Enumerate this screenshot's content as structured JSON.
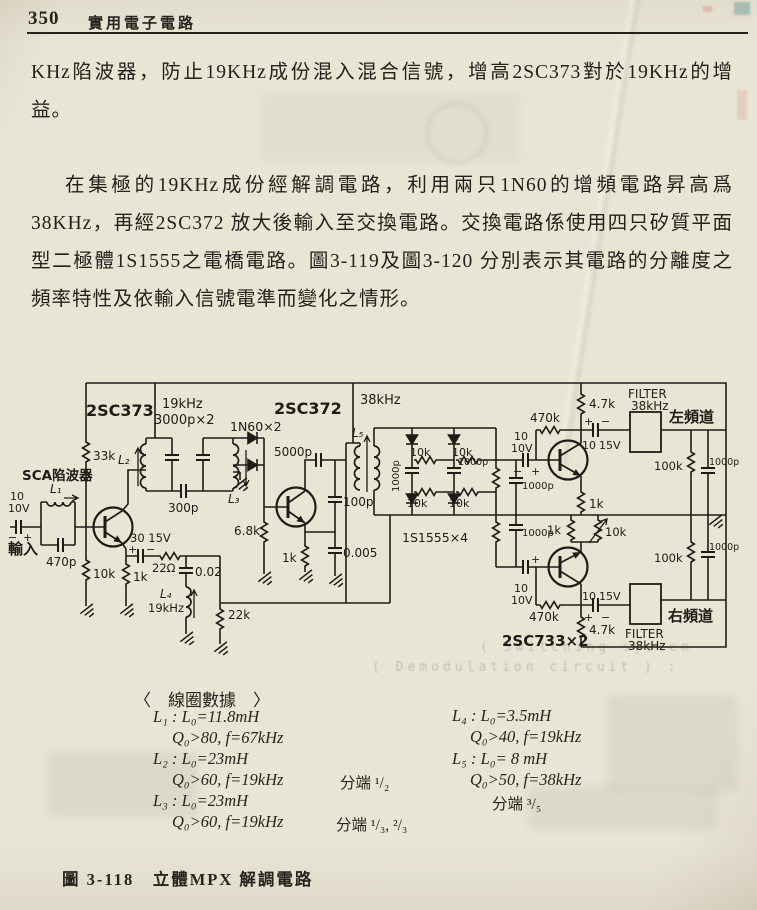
{
  "header": {
    "page_number": "350",
    "book_title": "實用電子電路"
  },
  "paragraphs": {
    "p1": "KHz陷波器，防止19KHz成份混入混合信號，增高2SC373對於19KHz的增益。",
    "p2": "在集極的19KHz成份經解調電路，利用兩只1N60的增頻電路昇高爲38KHz，再經2SC372 放大後輸入至交換電路。交換電路係使用四只矽質平面型二極體1S1555之電橋電路。圖3-119及圖3-120 分別表示其電路的分離度之頻率特性及依輸入信號電準而變化之情形。"
  },
  "circuit": {
    "labels": {
      "t1": "2SC373",
      "t2": "2SC372",
      "t3": "2SC733×2",
      "f19": "19kHz",
      "f38": "38kHz",
      "c3000": "3000p×2",
      "d160": "1N60×2",
      "dbr": "1S1555×4",
      "L1": "L₁",
      "L2": "L₂",
      "L3": "L₃",
      "L4": "L₄",
      "L5": "L₅",
      "sca": "SCA陷波器",
      "input": "輸入",
      "chL": "左頻道",
      "chR": "右頻道",
      "r33k": "33k",
      "r10k": "10k",
      "r1k": "1k",
      "r22o": "22Ω",
      "r22k": "22k",
      "r68k": "6.8k",
      "r47k": "4.7k",
      "r470k": "470k",
      "r100k": "100k",
      "c470p": "470p",
      "c300p": "300p",
      "c5000p": "5000p",
      "c100p": "100p",
      "c1000p": "1000p",
      "c0005": "0.005",
      "c002": "0.02",
      "v10": "10",
      "v10v": "10V",
      "v15v": "15V",
      "v3015": "30 15V",
      "filter": "FILTER",
      "plus": "+",
      "minus": "−"
    }
  },
  "coil_data": {
    "title": "〈　線圈數據　〉",
    "left": [
      {
        "l": "L₁ : L₀=11.8mH",
        "q": "Q₀>80, f=67kHz",
        "tap": ""
      },
      {
        "l": "L₂ : L₀=23mH",
        "q": "Q₀>60, f=19kHz",
        "tap": "分端 ¹/₂"
      },
      {
        "l": "L₃ : L₀=23mH",
        "q": "Q₀>60, f=19kHz",
        "tap": "分端  ¹/₃, ²/₃"
      }
    ],
    "right": [
      {
        "l": "L₄ : L₀=3.5mH",
        "q": "Q₀>40, f=19kHz",
        "tap": ""
      },
      {
        "l": "L₅ : L₀= 8 mH",
        "q": "Q₀>50, f=38kHz",
        "tap": "分端  ³/₅"
      }
    ]
  },
  "caption": {
    "text": "圖 3-118　立體MPX 解調電路"
  },
  "bleed": {
    "line1": "( Switching system",
    "line2": "( Demodulation circuit ) :"
  }
}
